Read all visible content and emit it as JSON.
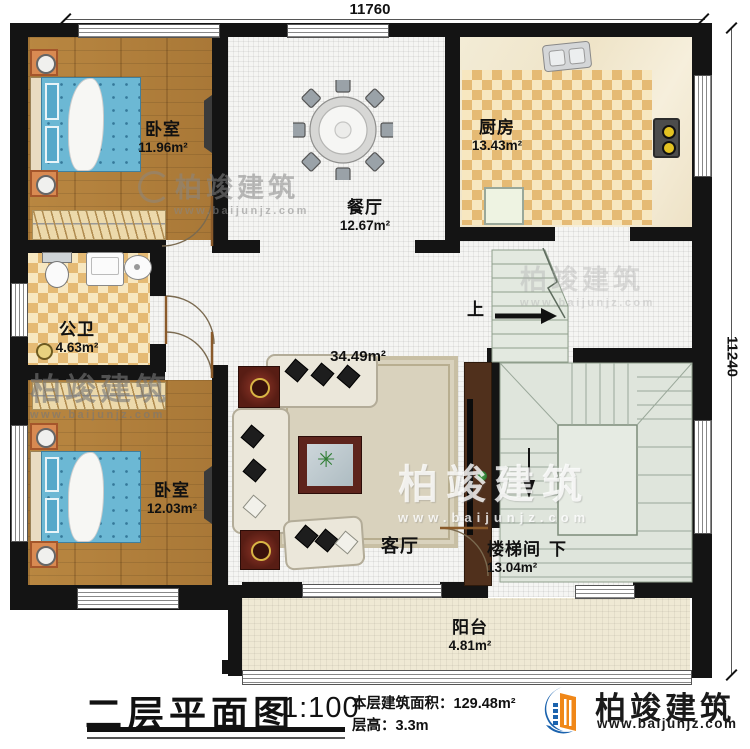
{
  "dimensions": {
    "top": "11760",
    "right": "11240"
  },
  "rooms": {
    "bedroom1": {
      "name": "卧室",
      "area": "11.96m²"
    },
    "dining": {
      "name": "餐厅",
      "area": "12.67m²"
    },
    "kitchen": {
      "name": "厨房",
      "area": "13.43m²"
    },
    "bathroom": {
      "name": "公卫",
      "area": "4.63m²"
    },
    "bedroom2": {
      "name": "卧室",
      "area": "12.03m²"
    },
    "living": {
      "name": "客厅",
      "area": "34.49m²"
    },
    "stairwell": {
      "name": "楼梯间",
      "area": "13.04m²",
      "down_label": "下"
    },
    "balcony": {
      "name": "阳台",
      "area": "4.81m²"
    }
  },
  "stairs": {
    "up_label": "上"
  },
  "titleblock": {
    "title": "二层平面图",
    "scale": "1:100",
    "area_line": "本层建筑面积：129.48m²",
    "height_line": "层高：3.3m"
  },
  "brand": {
    "name": "柏竣建筑",
    "url": "www.baijunjz.com"
  },
  "watermark": {
    "name": "柏竣建筑",
    "url": "www.baijunjz.com"
  },
  "colors": {
    "wall": "#141414",
    "wood": "#b5823f",
    "checker": "#e5ba74",
    "stair_floor": "#dfe5dc",
    "brand_blue": "#1b63ae",
    "brand_orange": "#f08718"
  }
}
